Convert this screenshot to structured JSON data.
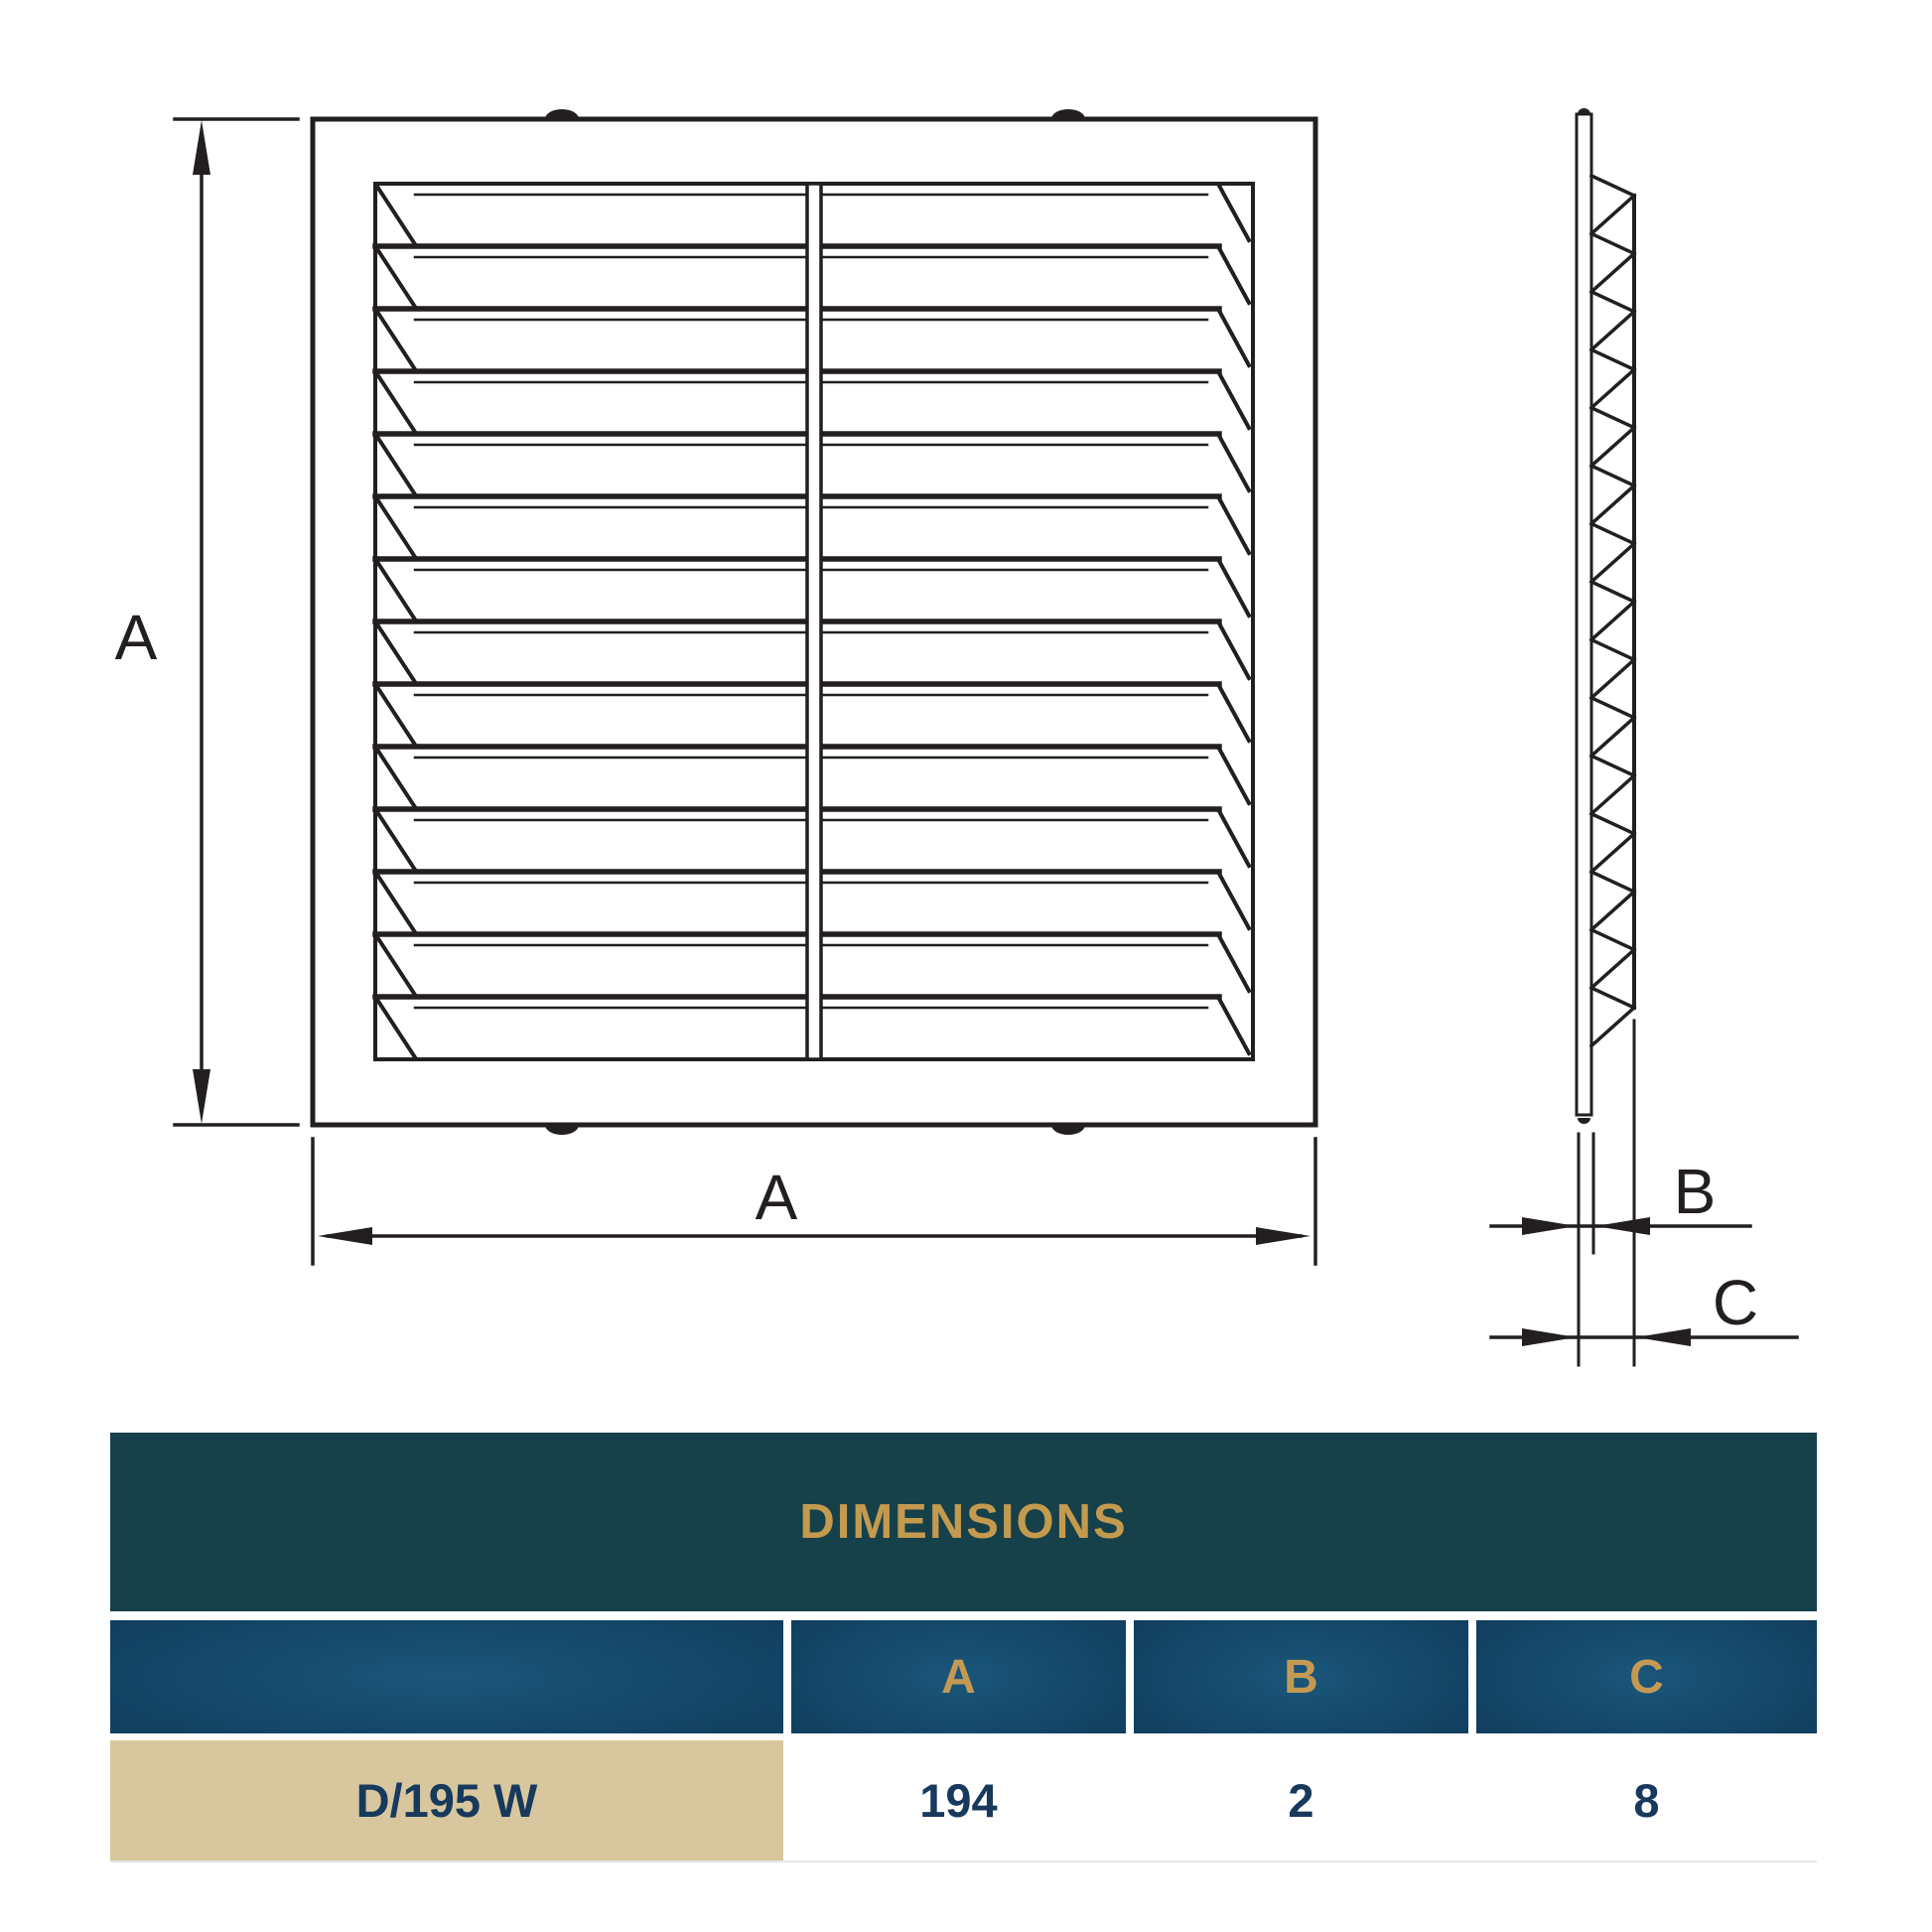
{
  "drawing": {
    "line_color": "#231f20",
    "front_view": {
      "louver_count": 14
    },
    "side_view": {
      "louver_count": 15
    },
    "labels": {
      "height": "A",
      "width": "A",
      "thickness": "B",
      "depth": "C"
    }
  },
  "table": {
    "title": "DIMENSIONS",
    "title_color": "#c49a4e",
    "header_bg": "#16404a",
    "columns": [
      "A",
      "B",
      "C"
    ],
    "row": {
      "model": "D/195 W",
      "values": {
        "A": "194",
        "B": "2",
        "C": "8"
      }
    }
  }
}
